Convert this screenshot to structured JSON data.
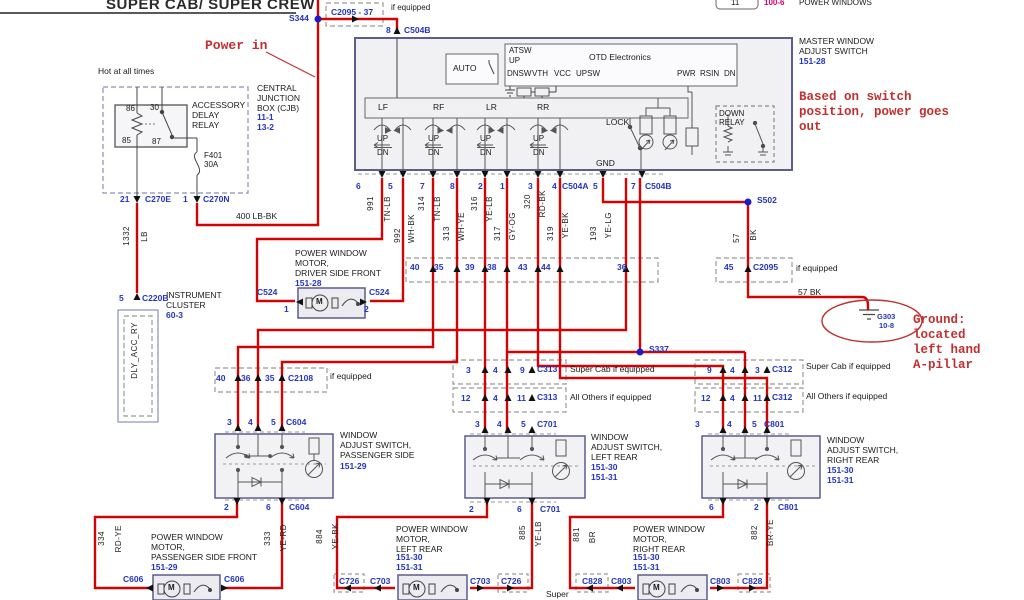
{
  "header": {
    "title": "SUPER CAB/ SUPER CREW",
    "cell": "11",
    "ref": "100-6",
    "label": "POWER WINDOWS"
  },
  "notes": {
    "power_in": "Power in",
    "based_on": "Based on switch\nposition, power goes\nout",
    "ground": "Ground:\nlocated\nleft hand\nA-pillar",
    "hot": "Hot at all times",
    "if_equipped": "if equipped",
    "super": "Super"
  },
  "cjb": {
    "relay": "ACCESSORY\nDELAY\nRELAY",
    "p86": "86",
    "p30": "30",
    "p85": "85",
    "p87": "87",
    "fuse": "F401\n30A",
    "name": "CENTRAL\nJUNCTION\nBOX (CJB)",
    "refs": "11-1\n13-2",
    "pin21": "21",
    "c270e": "C270E",
    "pin1": "1",
    "c270n": "C270N",
    "wire400": "400   LB-BK"
  },
  "cluster": {
    "wire": "1332",
    "color": "LB",
    "pin": "5",
    "conn": "C220B",
    "name": "INSTRUMENT\nCLUSTER",
    "ref": "60-3",
    "signal": "DLY_ACC_RY"
  },
  "splices": {
    "s344": "S344",
    "s502": "S502",
    "s337": "S337"
  },
  "top_conn": {
    "label": "C2095 - 37",
    "pin": "8",
    "conn": "C504B"
  },
  "msw": {
    "name": "MASTER WINDOW\nADJUST SWITCH",
    "ref": "151-28",
    "auto": "AUTO",
    "atsw": "ATSW",
    "up": "UP",
    "dnsw": "DNSW",
    "vth": "VTH",
    "vcc": "VCC",
    "upsw": "UPSW",
    "otd": "OTD Electronics",
    "pwr": "PWR",
    "rsin": "RSIN",
    "dn": "DN",
    "lf": "LF",
    "rf": "RF",
    "lr": "LR",
    "rr": "RR",
    "sw_up": "UP",
    "sw_dn": "DN",
    "lock": "LOCK",
    "gnd": "GND",
    "down_relay": "DOWN\nRELAY",
    "pins": [
      "6",
      "5",
      "7",
      "8",
      "2",
      "1",
      "3",
      "4"
    ],
    "c504a_pin": "5",
    "c504a": "C504A",
    "c504b_pin": "7",
    "c504b": "C504B"
  },
  "wires": {
    "w991": "991",
    "c991": "TN-LB",
    "w992": "992",
    "c992": "WH-BK",
    "w314": "314",
    "c314": "TN-LB",
    "w313": "313",
    "c313": "WH-YE",
    "w316": "316",
    "c316": "YE-LB",
    "w317": "317",
    "c317": "GY-OG",
    "w320": "320",
    "c320": "RD-BK",
    "w319": "319",
    "c319": "YE-BK",
    "w193": "193",
    "c193": "YE-LG",
    "w57": "57",
    "c57": "BK",
    "w57h": "57   BK"
  },
  "crow": {
    "n40": "40",
    "n35": "35",
    "n39": "39",
    "n38": "38",
    "n43": "43",
    "n44": "44",
    "n36": "36",
    "n45": "45",
    "conn": "C2095"
  },
  "ground": {
    "g": "G303",
    "ref": "10-8"
  },
  "dmotor": {
    "name": "POWER WINDOW\nMOTOR,\nDRIVER SIDE FRONT",
    "ref": "151-28",
    "cl": "C524",
    "pl": "1",
    "cr": "C524",
    "pr": "2",
    "m": "M"
  },
  "bleft": {
    "n1": "40",
    "n2": "36",
    "n3": "35",
    "c1": "C2108",
    "pt1": "3",
    "pt2": "4",
    "pt3": "5",
    "ct": "C604",
    "sw": "WINDOW\nADJUST SWITCH,\nPASSENGER SIDE",
    "swref": "151-29",
    "pb1": "2",
    "pb2": "6",
    "cb": "C604",
    "wl": "334",
    "wlc": "RD-YE",
    "wr": "333",
    "wrc": "YE-RD",
    "mt": "POWER WINDOW\nMOTOR,\nPASSENGER SIDE FRONT",
    "mref": "151-29",
    "ml": "C606",
    "mr": "C606",
    "m": "M"
  },
  "bmid": {
    "r1a": "3",
    "r1b": "4",
    "r1c": "9",
    "c1": "C313",
    "n1": "Super Cab if equipped",
    "r2a": "12",
    "r2b": "4",
    "r2c": "11",
    "c2": "C313",
    "n2": "All Others if equipped",
    "pt1": "3",
    "pt2": "4",
    "pt3": "5",
    "ct": "C701",
    "sw": "WINDOW\nADJUST SWITCH,\nLEFT REAR",
    "swref": "151-30\n151-31",
    "pb1": "2",
    "pb2": "6",
    "cb": "C701",
    "wl": "884",
    "wlc": "YE-BK",
    "wr": "885",
    "wrc": "YE-LB",
    "mt": "POWER WINDOW\nMOTOR,\nLEFT REAR",
    "mref": "151-30\n151-31",
    "ml1": "C726",
    "ml2": "C703",
    "mr1": "C703",
    "mr2": "C726",
    "m": "M"
  },
  "bright": {
    "r1a": "9",
    "r1b": "4",
    "r1c": "3",
    "c1": "C312",
    "n1": "Super Cab if equipped",
    "r2a": "12",
    "r2b": "4",
    "r2c": "11",
    "c2": "C312",
    "n2": "All Others if equipped",
    "pt1": "3",
    "pt2": "4",
    "pt3": "5",
    "ct": "C801",
    "sw": "WINDOW\nADJUST SWITCH,\nRIGHT REAR",
    "swref": "151-30\n151-31",
    "pb1": "6",
    "pb2": "2",
    "cb": "C801",
    "wl": "881",
    "wlc": "BR",
    "wr": "882",
    "wrc": "BR-YE",
    "mt": "POWER WINDOW\nMOTOR,\nRIGHT REAR",
    "mref": "151-30\n151-31",
    "ml1": "C828",
    "ml2": "C803",
    "mr1": "C803",
    "mr2": "C828",
    "m": "M"
  }
}
